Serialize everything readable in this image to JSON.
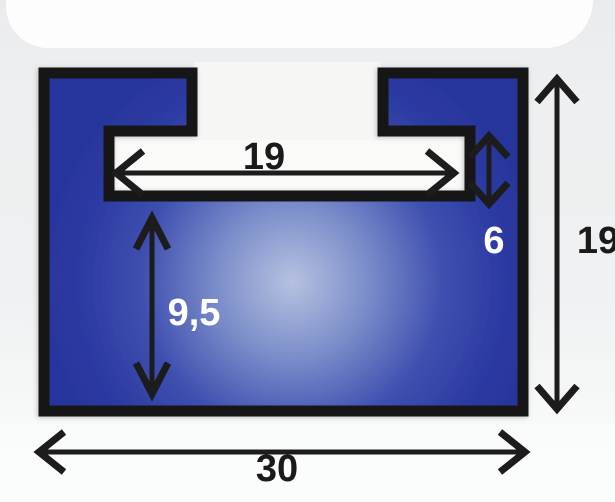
{
  "diagram": {
    "dimensions": {
      "slot_width": "19",
      "slot_depth": "6",
      "overall_height": "19",
      "base_height": "9,5",
      "overall_width": "30"
    },
    "colors": {
      "outline": "#161616",
      "arrow": "#1c1c1c",
      "label_dark": "#1a1a1a",
      "label_light": "#ffffff",
      "profile_blue_dark": "#27359b",
      "profile_blue_mid": "#3f50b0",
      "profile_highlight": "#b6c1e0",
      "background": "#edeff0",
      "cavity_white": "#fafaf8"
    }
  }
}
